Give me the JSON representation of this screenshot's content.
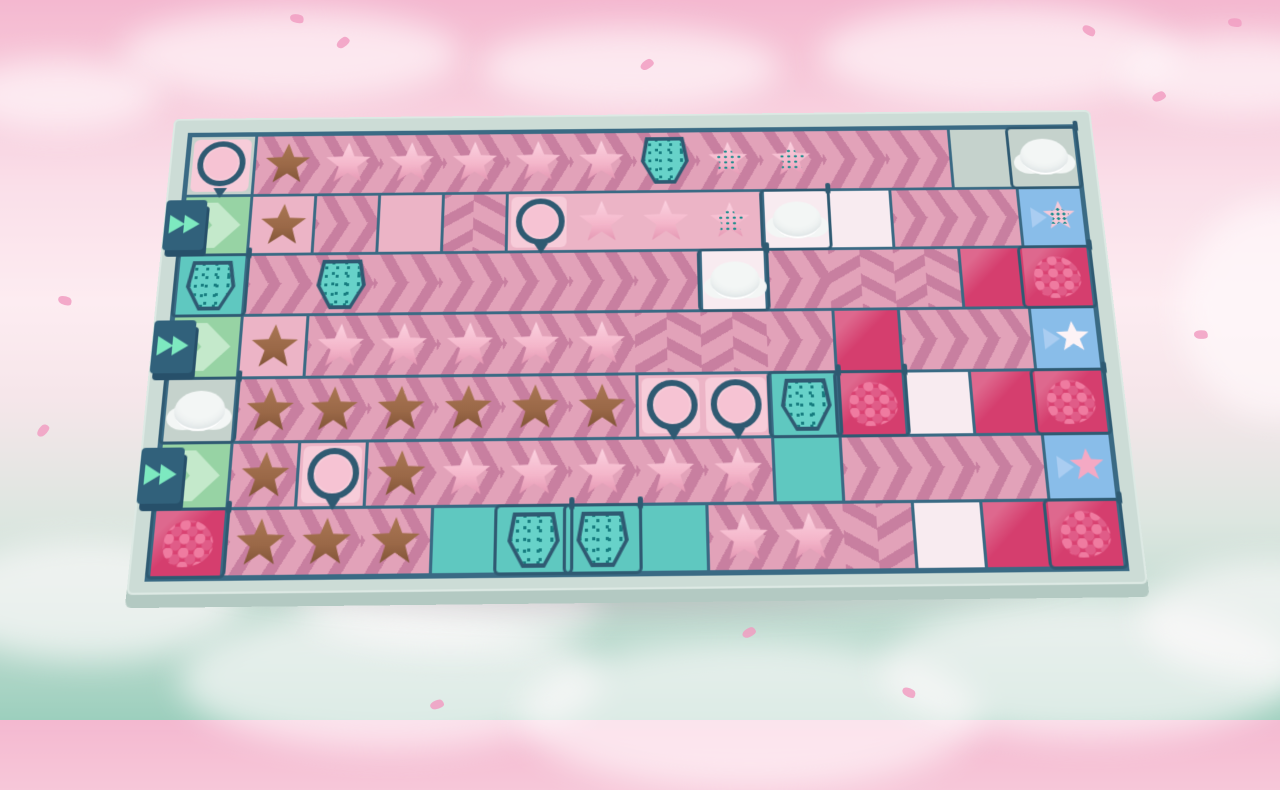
{
  "scene": {
    "description": "Top-down cookie-factory conveyor puzzle board floating among pink and mint clouds",
    "visible_text": [],
    "hud": {}
  },
  "colors": {
    "bg_top": "#f4b8d0",
    "bg_mid": "#fdecf1",
    "bg_bottom": "#9ccfbd",
    "board_frame": "#ccdcd6",
    "board_frame_side": "#b3c9c2",
    "wall": "#3a6a84",
    "wall_dark": "#2f5a72",
    "belt_pink": "#e2a2b9",
    "belt_stripe": "#c87fa0",
    "tile_pink": "#ecb4c6",
    "tile_white": "#f8ebf0",
    "tile_gray": "#c5d2cc",
    "tile_teal": "#5fc8c0",
    "sprinkle_teal": "#67d2c9",
    "sprinkle_dot": "#177d80",
    "tile_magenta": "#d53e6e",
    "tile_blue_goal": "#89bde9",
    "goal_arrow": "#aacdf1",
    "tile_green_input": "#97d3a4",
    "green_chevron": "#c4e9cb",
    "fast_forward_mint": "#7de9c0",
    "cookie_brown": "#9a6847",
    "cookie_pink": "#f4b6ca",
    "cream_white": "#f3f6f5",
    "raspberry": "#d94272"
  },
  "board": {
    "rows": 7,
    "cols": 14,
    "tile_w": 66,
    "tile_h": 64,
    "cell_codes": {
      "floors": {
        "belt-r": "pink conveyor belt, chevrons pointing right",
        "belt-d": "pink conveyor belt, chevrons pointing down",
        "belt-u": "pink conveyor belt, chevrons pointing up",
        "pink": "plain pink tile",
        "white": "pale empty tile",
        "gray": "bare board floor",
        "teal": "teal tile",
        "magenta": "magenta jam tile",
        "blue": "blue order/output tile",
        "green": "green input tile with chevron"
      },
      "items": {
        "star-brown": "chocolate star cookie",
        "star-pink": "pink frosted star cookie",
        "star-sprinkle": "pink star cookie with teal sprinkles",
        "press": "round pink frosting press machine",
        "sprinkler": "teal sprinkle dispenser machine",
        "cloud": "whipped-cream cloud machine",
        "berry": "raspberry dispenser",
        "ff": "fast-forward input block with double arrows",
        "goal-sprinkle": "order tile: star with sprinkles",
        "goal-frosted": "order tile: white frosted star",
        "goal-star": "order tile: plain pink star"
      }
    },
    "grid": [
      [
        "gray|press",
        "belt-r|star-brown",
        "belt-r|star-pink",
        "belt-r|star-pink",
        "belt-r|star-pink",
        "belt-r|star-pink",
        "belt-r|star-pink",
        "belt-r|sprinkler",
        "belt-r|star-sprinkle",
        "belt-r|star-sprinkle",
        "belt-r|",
        "belt-r|",
        "gray|",
        "gray|cloud"
      ],
      [
        "green|ff",
        "pink|star-brown",
        "belt-r|",
        "pink|",
        "belt-d|",
        "pink|press",
        "pink|star-pink",
        "pink|star-pink",
        "pink|star-sprinkle",
        "white|cloud",
        "white|",
        "belt-r|",
        "belt-r|",
        "blue|goal-sprinkle"
      ],
      [
        "teal|sprinkler",
        "belt-r|",
        "belt-r|sprinkler",
        "belt-r|",
        "belt-r|",
        "belt-r|",
        "belt-r|",
        "belt-r|",
        "white|cloud",
        "belt-r|",
        "belt-d|",
        "belt-d|",
        "magenta|",
        "magenta|berry"
      ],
      [
        "green|ff",
        "pink|star-brown",
        "belt-r|star-pink",
        "belt-r|star-pink",
        "belt-r|star-pink",
        "belt-r|star-pink",
        "belt-r|star-pink",
        "belt-d|",
        "belt-d|",
        "belt-r|",
        "magenta|",
        "belt-r|",
        "belt-r|",
        "blue|goal-frosted"
      ],
      [
        "gray|cloud",
        "belt-r|star-brown",
        "belt-r|star-brown",
        "belt-r|star-brown",
        "belt-r|star-brown",
        "belt-r|star-brown",
        "belt-r|star-brown",
        "pink|press",
        "pink|press",
        "teal|sprinkler",
        "magenta|berry",
        "white|",
        "magenta|",
        "magenta|berry"
      ],
      [
        "green|ff",
        "belt-r|star-brown",
        "pink|press",
        "belt-r|star-brown",
        "belt-r|star-pink",
        "belt-r|star-pink",
        "belt-r|star-pink",
        "belt-r|star-pink",
        "belt-r|star-pink",
        "teal|",
        "belt-r|",
        "belt-r|",
        "belt-r|",
        "blue|goal-star"
      ],
      [
        "magenta|berry",
        "belt-r|star-brown",
        "belt-r|star-brown",
        "belt-r|star-brown",
        "teal|",
        "teal|sprinkler",
        "teal|sprinkler",
        "teal|",
        "belt-r|star-pink",
        "belt-r|star-pink",
        "belt-u|",
        "white|",
        "magenta|",
        "magenta|berry"
      ]
    ]
  },
  "decor": {
    "bg_clouds": [
      {
        "x": 120,
        "y": 10,
        "w": 340,
        "h": 90
      },
      {
        "x": 480,
        "y": 28,
        "w": 300,
        "h": 80
      },
      {
        "x": 820,
        "y": 5,
        "w": 360,
        "h": 100
      },
      {
        "x": 1120,
        "y": 35,
        "w": 240,
        "h": 80
      },
      {
        "x": -40,
        "y": 60,
        "w": 200,
        "h": 70
      },
      {
        "x": 1180,
        "y": 200,
        "w": 200,
        "h": 220
      },
      {
        "x": -60,
        "y": 540,
        "w": 300,
        "h": 120
      },
      {
        "x": 180,
        "y": 610,
        "w": 420,
        "h": 140
      },
      {
        "x": 520,
        "y": 640,
        "w": 460,
        "h": 150
      },
      {
        "x": 880,
        "y": 600,
        "w": 420,
        "h": 140
      },
      {
        "x": 1140,
        "y": 560,
        "w": 260,
        "h": 120
      },
      {
        "x": 300,
        "y": 560,
        "w": 300,
        "h": 90
      }
    ],
    "petals": [
      {
        "x": 290,
        "y": 14,
        "r": 20
      },
      {
        "x": 336,
        "y": 38,
        "r": -30
      },
      {
        "x": 1082,
        "y": 26,
        "r": 40
      },
      {
        "x": 1152,
        "y": 92,
        "r": -15
      },
      {
        "x": 58,
        "y": 296,
        "r": 25
      },
      {
        "x": 36,
        "y": 426,
        "r": -40
      },
      {
        "x": 1194,
        "y": 330,
        "r": 10
      },
      {
        "x": 742,
        "y": 628,
        "r": -20
      },
      {
        "x": 902,
        "y": 688,
        "r": 35
      },
      {
        "x": 430,
        "y": 700,
        "r": -10
      },
      {
        "x": 1228,
        "y": 18,
        "r": 15
      },
      {
        "x": 640,
        "y": 60,
        "r": -25
      }
    ]
  }
}
